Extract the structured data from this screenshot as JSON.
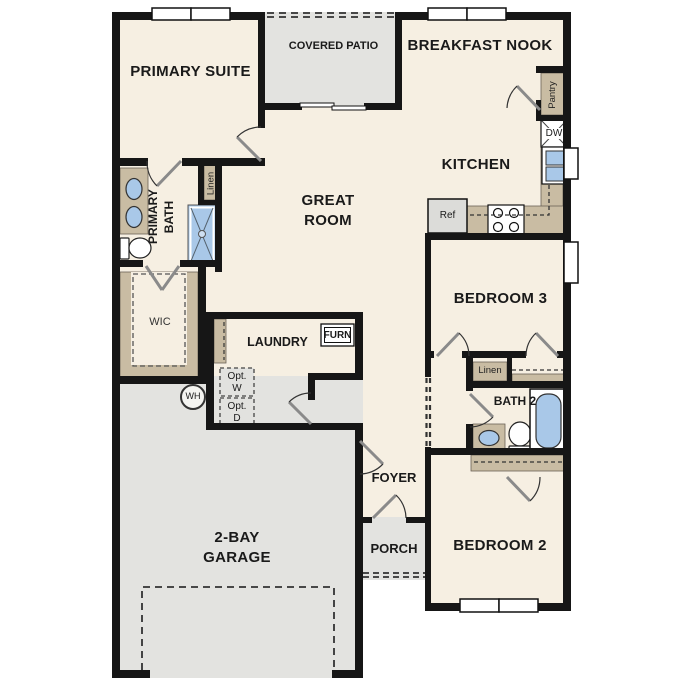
{
  "rooms": {
    "primary_suite": "PRIMARY SUITE",
    "covered_patio": "COVERED PATIO",
    "breakfast_nook": "BREAKFAST NOOK",
    "kitchen": "KITCHEN",
    "great_room": "GREAT ROOM",
    "primary_bath": "PRIMARY BATH",
    "wic": "WIC",
    "laundry": "LAUNDRY",
    "bedroom_3": "BEDROOM 3",
    "bath_2": "BATH 2",
    "bedroom_2": "BEDROOM 2",
    "foyer": "FOYER",
    "porch": "PORCH",
    "garage": "2-BAY GARAGE"
  },
  "closets": {
    "pantry": "Pantry",
    "linen_primary": "Linen",
    "linen_hall": "Linen"
  },
  "appliances": {
    "dishwasher": "DW",
    "refrigerator": "Ref",
    "furnace": "FURN",
    "water_heater": "WH",
    "optional_washer": "Opt. W",
    "optional_dryer": "Opt. D"
  },
  "colors": {
    "floor": "#f6efe2",
    "outdoor": "#e3e3e0",
    "casework": "#c9bca3",
    "fixture": "#a9c8e8",
    "wall": "#161616"
  }
}
